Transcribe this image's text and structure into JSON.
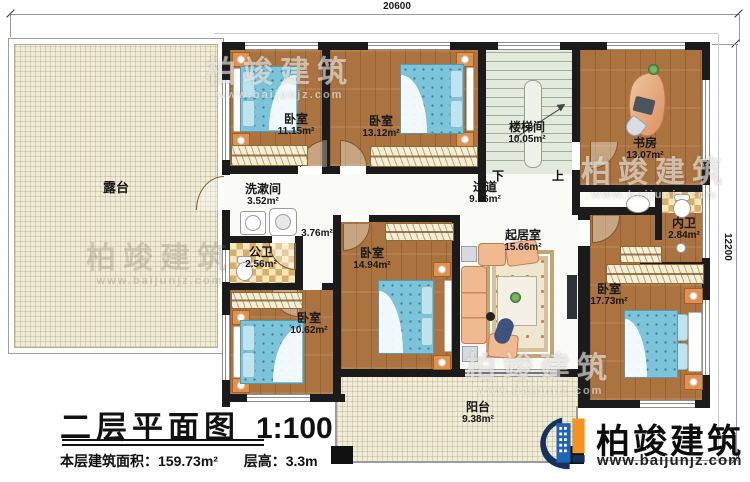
{
  "plan_title": {
    "main": "二层平面图",
    "scale": "1:100",
    "area_label": "本层建筑面积：",
    "area_value": "159.73m²",
    "height_label": "层高：",
    "height_value": "3.3m"
  },
  "dimensions": {
    "top": "20600",
    "right": "12200"
  },
  "stairs": {
    "down": "下",
    "up": "上"
  },
  "rooms": {
    "terrace": {
      "name": "露台",
      "area": ""
    },
    "bedroom_a": {
      "name": "卧室",
      "area": "11.15m²"
    },
    "bedroom_b": {
      "name": "卧室",
      "area": "13.12m²"
    },
    "stairwell": {
      "name": "楼梯间",
      "area": "10.05m²"
    },
    "study": {
      "name": "书房",
      "area": "13.07m²"
    },
    "washroom": {
      "name": "洗漱间",
      "area": "3.52m²"
    },
    "public_bath": {
      "name": "公卫",
      "area": "2.56m²"
    },
    "corridor_nook": {
      "name": "",
      "area": "3.76m²"
    },
    "hallway": {
      "name": "过道",
      "area": "9.86m²"
    },
    "bedroom_c": {
      "name": "卧室",
      "area": "14.94m²"
    },
    "bedroom_d": {
      "name": "卧室",
      "area": "10.62m²"
    },
    "living": {
      "name": "起居室",
      "area": "15.66m²"
    },
    "inner_bath": {
      "name": "内卫",
      "area": "2.84m²"
    },
    "bedroom_e": {
      "name": "卧室",
      "area": "17.73m²"
    },
    "balcony": {
      "name": "阳台",
      "area": "9.38m²"
    }
  },
  "brand": {
    "name": "柏竣建筑",
    "url": "www.baijunjz.com"
  },
  "watermark": {
    "name": "柏竣建筑",
    "url": "www.baijunjz.com"
  },
  "colors": {
    "wall": "#1b1b1b",
    "wood": "#aa7340",
    "tile": "#f1ecd7",
    "bed_blue": "#7cc4da",
    "brand_blue": "#1e63b5",
    "brand_orange": "#f6921e",
    "brand_navy": "#16325c"
  }
}
